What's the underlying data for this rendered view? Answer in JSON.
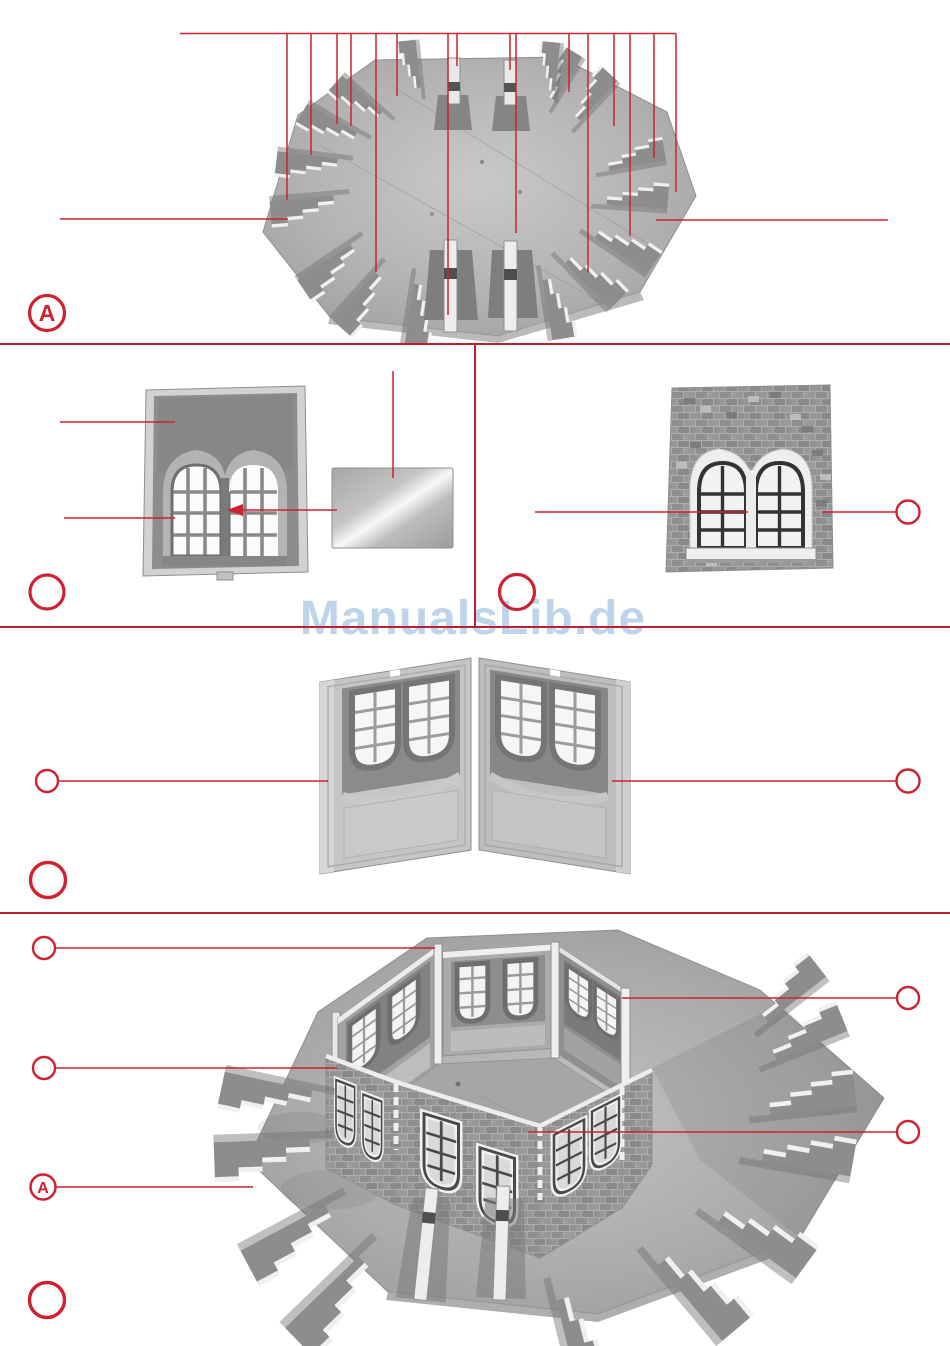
{
  "page": {
    "width": 950,
    "height": 1346,
    "background": "#ffffff",
    "kind": "assembly-manual-page"
  },
  "colors": {
    "accent_red": "#cf2130",
    "divider_red": "#bb2033",
    "watermark_blue": "#bed4ea",
    "photo_grey": "#b2b2b2",
    "brick_grey": "#8f8f8f",
    "trim_white": "#f0f0f0"
  },
  "watermark": {
    "text": "ManualsLib.de"
  },
  "labels": {
    "base_plate": "A",
    "assembled_base": "A"
  },
  "figures": {
    "step1": "octagonal-base-plate-top-view",
    "step2_left": "wall-window-part-inner-side",
    "step2_glazing": "glazing-sheet",
    "step2_right": "brick-wall-part-outer-side",
    "step3": "two-wall-parts-joined-at-angle",
    "step4": "wall-ring-assembled-on-base-plate"
  },
  "callouts": {
    "step1": {
      "top_fan_lines": 16,
      "side_leader_lines": 2,
      "circled_label": "A"
    },
    "step2_left": {
      "leader_lines": 2,
      "arrow_leaders": 1,
      "glazing_leader_lines": 1,
      "empty_circles": 1
    },
    "step2_right": {
      "leader_lines": 2,
      "empty_circles": 2
    },
    "step3": {
      "leader_lines": 2,
      "empty_circles": 3
    },
    "step4": {
      "leader_lines": 5,
      "empty_circles": 5,
      "circled_label": "A"
    }
  }
}
